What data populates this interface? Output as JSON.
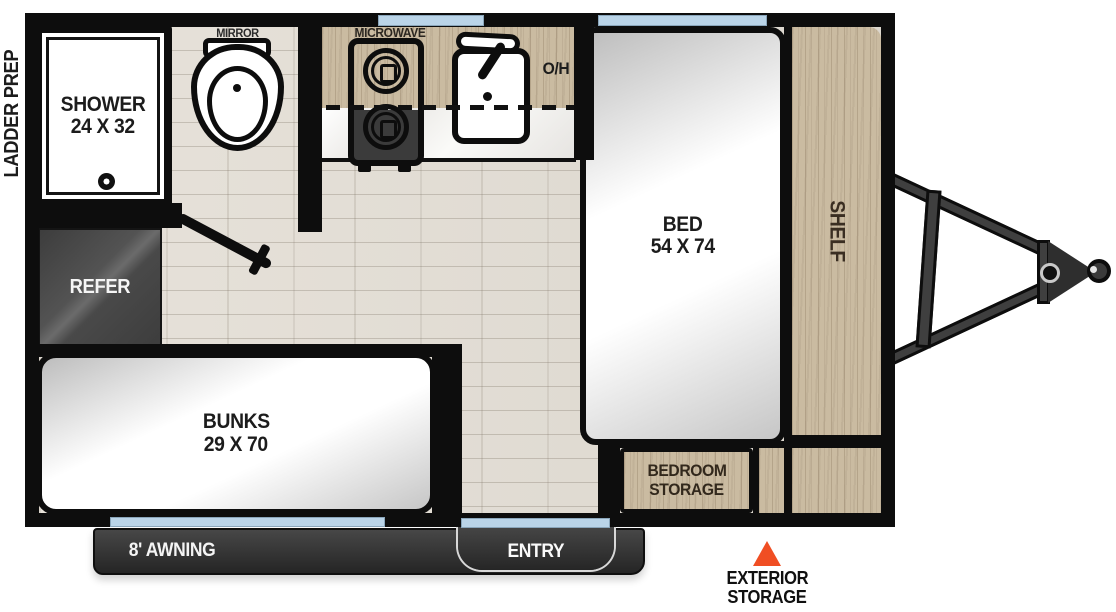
{
  "diagram_type": "rv-travel-trailer-floorplan",
  "colors": {
    "wall": "#0d0d0d",
    "wood": "#cabba1",
    "floor": "#e2ddd5",
    "window_blue": "#bad4e8",
    "appliance_gray": "#454545",
    "marker_orange": "#f04e23"
  },
  "exterior": {
    "ladder_prep": "LADDER PREP",
    "awning": "8' AWNING",
    "entry": "ENTRY",
    "exterior_storage_line1": "EXTERIOR",
    "exterior_storage_line2": "STORAGE"
  },
  "bathroom": {
    "shower_name": "SHOWER",
    "shower_size": "24 X 32",
    "mirror": "MIRROR"
  },
  "kitchen": {
    "microwave": "MICROWAVE",
    "overhead": "O/H",
    "refer": "REFER"
  },
  "bedroom": {
    "bed_name": "BED",
    "bed_size": "54 X 74",
    "shelf": "SHELF",
    "storage_line1": "BEDROOM",
    "storage_line2": "STORAGE"
  },
  "bunk_area": {
    "bunks_name": "BUNKS",
    "bunks_size": "29 X 70"
  }
}
